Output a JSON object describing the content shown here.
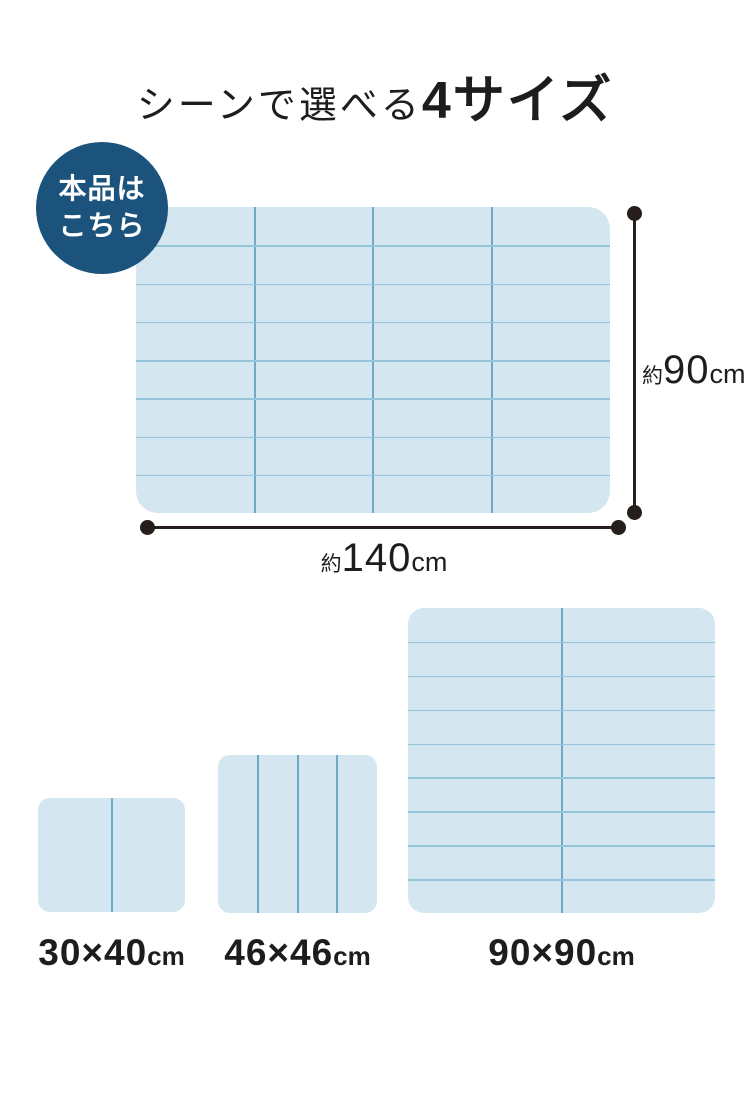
{
  "colors": {
    "page_bg": "#ffffff",
    "badge_bg": "#1b537d",
    "badge_text": "#ffffff",
    "mat_fill": "#d4e6f0",
    "grid_v": "#6fa9c6",
    "grid_h": "#93c4da",
    "dim": "#251e1b",
    "text": "#1d1d1d"
  },
  "title": {
    "prefix": "シーンで選べる",
    "highlight": "4サイズ"
  },
  "badge": {
    "lines": [
      "本品は",
      "こちら"
    ]
  },
  "main_mat": {
    "cols": 4,
    "rows": 8,
    "height_label": {
      "approx": "約",
      "value": "90",
      "unit": "cm"
    },
    "width_label": {
      "approx": "約",
      "value": "140",
      "unit": "cm"
    }
  },
  "size_variants": [
    {
      "value": "30×40",
      "unit": "cm",
      "cols": 2,
      "rows": 1
    },
    {
      "value": "46×46",
      "unit": "cm",
      "cols": 4,
      "rows": 1
    },
    {
      "value": "90×90",
      "unit": "cm",
      "cols": 2,
      "rows": 9
    }
  ]
}
